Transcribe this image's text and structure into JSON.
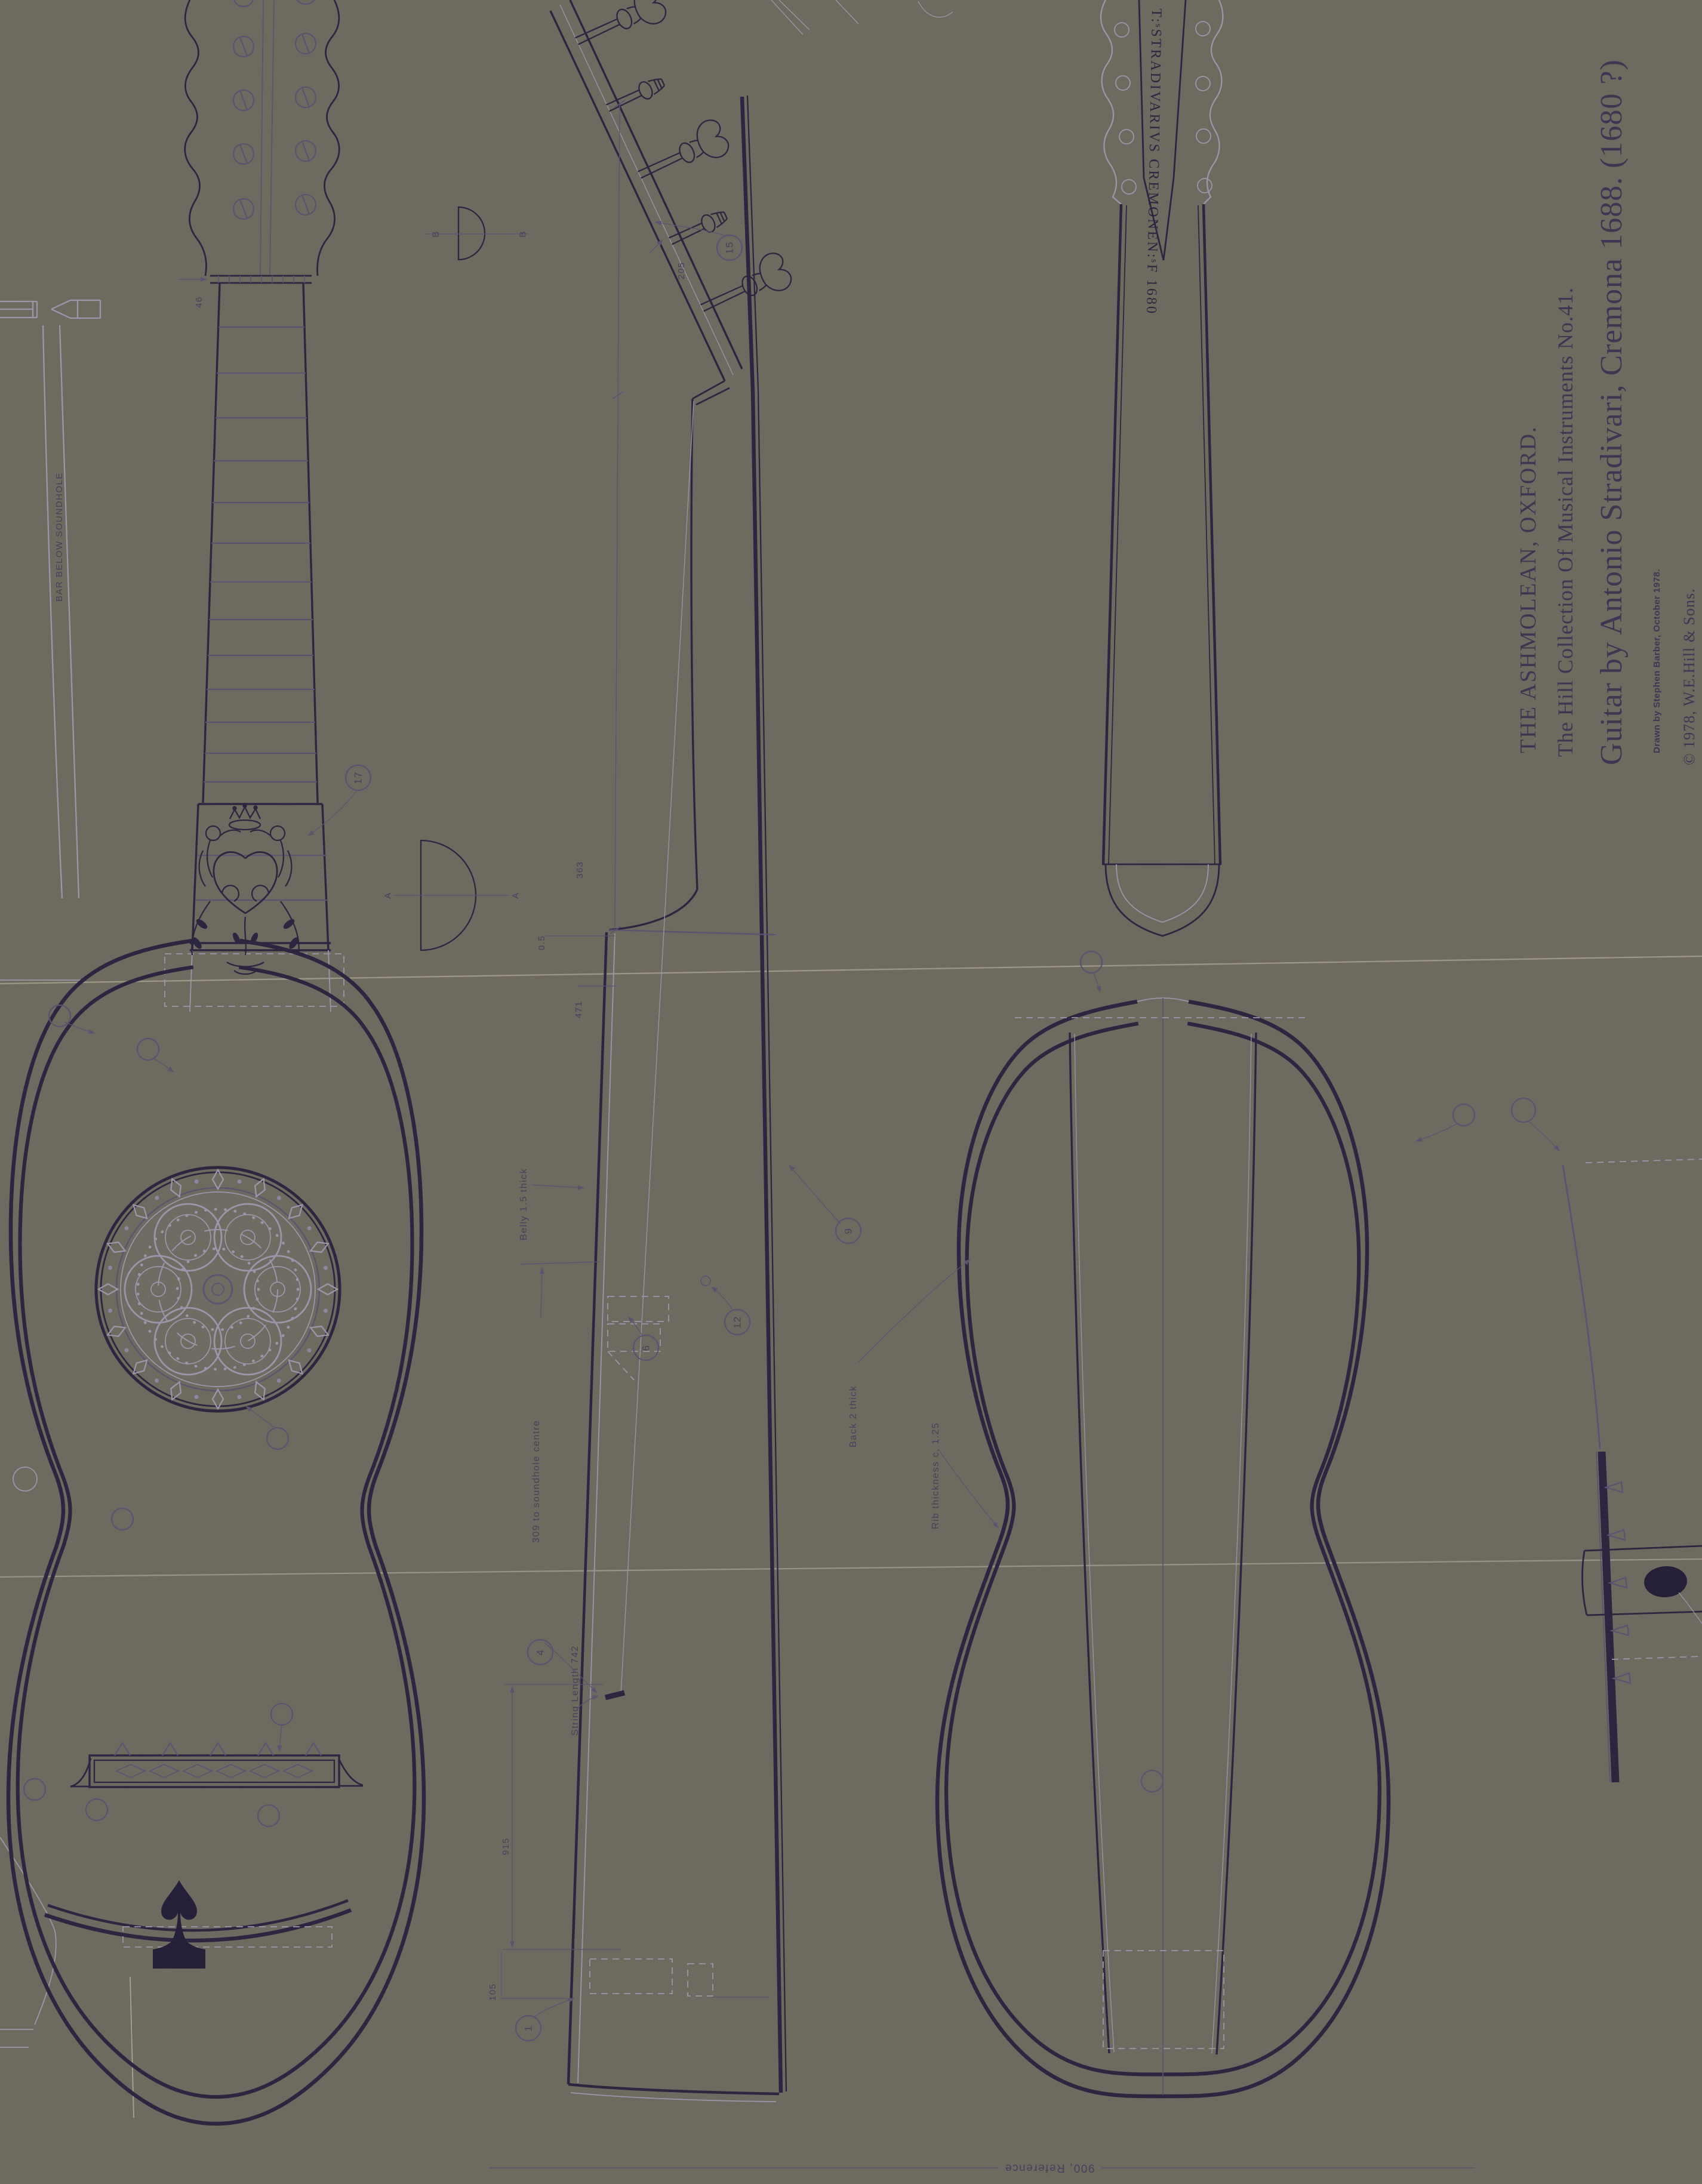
{
  "titleBlock": {
    "museum": "THE ASHMOLEAN, OXFORD.",
    "collection": "The Hill Collection Of Musical Instruments No.41.",
    "title": "Guitar by Antonio Stradivari, Cremona 1688. (1680 ?)",
    "credit": "Drawn by Stephen Barber, October 1978.",
    "copyright": "© 1978, W.E.Hill & Sons."
  },
  "inscription": "T:ˢSTRADIVARIVS CREMONEN:ˢF 1680",
  "labels": {
    "bar_below_soundhole": "BAR BELOW SOUNDHOLE",
    "belly_thick": "Belly 1.5 thick",
    "soundhole_centre": "309 to soundhole centre",
    "string_length": "String Length 742",
    "back_thick": "Back 2 thick",
    "rib_thickness": "Rib thickness c. 1.25",
    "reference": "900, Reference"
  },
  "dims": {
    "nut_width": "46",
    "head": "205",
    "d363": "363",
    "d05": "0.5",
    "d471": "471",
    "d915": "915",
    "d105": "105"
  },
  "sections": {
    "a": "A",
    "b": "B"
  },
  "callouts": {
    "c1": "1",
    "c4": "4",
    "c6": "6",
    "c9": "9",
    "c12": "12",
    "c15": "15",
    "c17": "17"
  },
  "colors": {
    "ink": "#2b2540",
    "paper": "#e9e4d5"
  }
}
